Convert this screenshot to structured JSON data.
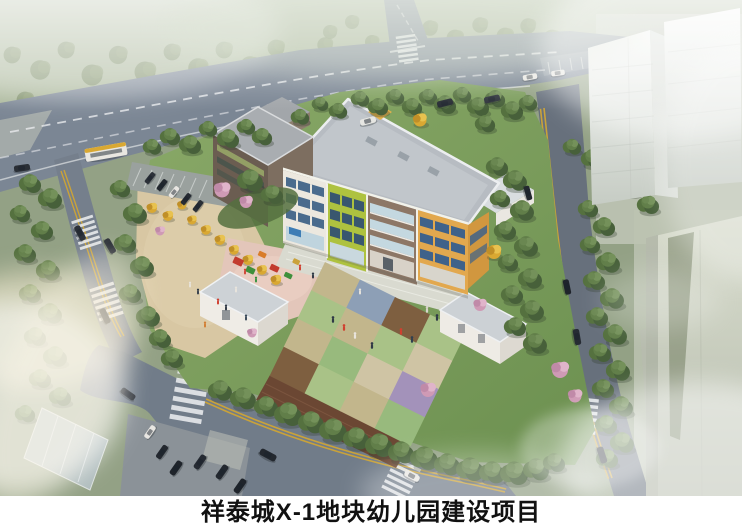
{
  "caption": {
    "title": "祥泰城X-1地块幼儿园建设项目"
  },
  "scene": {
    "type": "architectural-aerial-rendering",
    "subject": "Bird's-eye rendering of a kindergarten campus on an urban plot",
    "elements": [
      "main city road with cars and bus",
      "curved perimeter roads with double yellow lines and zebra crossings",
      "entrance plaza with paving and parking lots",
      "four-storey kindergarten building with white, lime-green, brown and yellow facade sections",
      "grey flat roof with parapets",
      "checkerboard colored playfield",
      "dark running track strip",
      "children playground with red, green and orange equipment",
      "white single-storey gatehouse and service buildings",
      "dense perimeter trees, yellow autumn trees and pink blossom trees",
      "hazy residential high-rise towers",
      "fog and sun flare"
    ],
    "palette": {
      "road": "#76818f",
      "lawn": "#7c9e5c",
      "plaza": "#d8c7a3",
      "facade_white": "#ece8df",
      "facade_green": "#aec23f",
      "facade_brown": "#8d7766",
      "facade_yellow": "#e2a84e",
      "roof": "#b7bcc2",
      "track": "#6b4733",
      "tile_blue": "#8d9fb6",
      "tile_purple": "#a392ba",
      "tower": "#d5d9cd",
      "caption_bg": "#ffffff",
      "caption_text": "#111111"
    }
  }
}
